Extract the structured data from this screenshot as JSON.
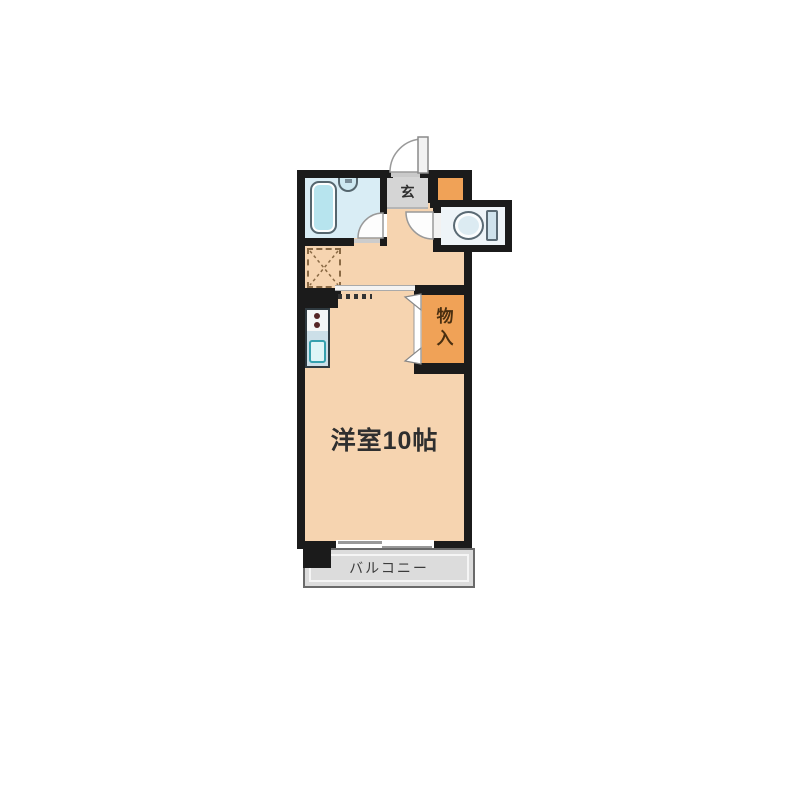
{
  "floorplan": {
    "type": "apartment-floor-plan",
    "labels": {
      "main_room": "洋室10帖",
      "entrance": "玄",
      "closet": "物入",
      "balcony": "バルコニー"
    },
    "colors": {
      "wall": "#1b1b1b",
      "room_fill": "#f6d4b0",
      "accent_orange": "#f0a257",
      "bathroom_fill": "#d9edf5",
      "bathtub_fill": "#b7e4ee",
      "entrance_fill": "#d5d5d5",
      "toilet_fill": "#eef4f8",
      "balcony_fill": "#dcdcdc"
    }
  }
}
